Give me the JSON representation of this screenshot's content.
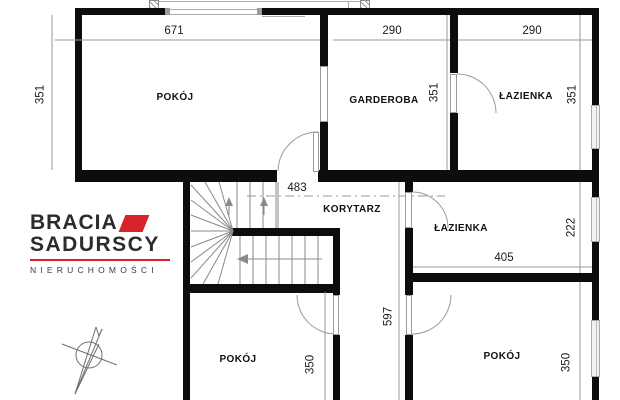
{
  "brand": {
    "line1": "BRACIA",
    "line2": "SADURSCY",
    "tagline": "NIERUCHOMOŚCI",
    "accent_color": "#d8232a",
    "text_color": "#2b2b30"
  },
  "rooms": [
    {
      "id": "room-top-left",
      "name": "POKÓJ",
      "width": "671",
      "height": "351"
    },
    {
      "id": "wardrobe",
      "name": "GARDEROBA",
      "width": "290",
      "height": "351"
    },
    {
      "id": "bath-top-right",
      "name": "ŁAZIENKA",
      "width": "290",
      "height": "351"
    },
    {
      "id": "corridor",
      "name": "KORYTARZ",
      "width": "483",
      "height": "597"
    },
    {
      "id": "bath-middle",
      "name": "ŁAZIENKA",
      "width": "405",
      "height": "222"
    },
    {
      "id": "room-bottom-left",
      "name": "POKÓJ",
      "height": "350"
    },
    {
      "id": "room-bottom-right",
      "name": "POKÓJ",
      "height": "350"
    }
  ]
}
